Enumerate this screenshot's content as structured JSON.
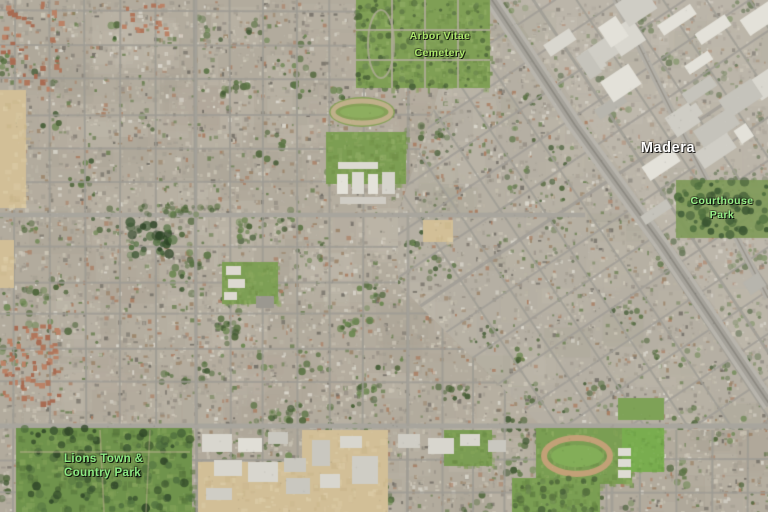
{
  "map": {
    "labels": [
      {
        "id": "arbor-vitae-cemetery",
        "text": "Arbor Vitae\nCemetery",
        "color": "#aee86d"
      },
      {
        "id": "madera",
        "text": "Madera",
        "color": "#ffffff"
      },
      {
        "id": "courthouse-park",
        "text": "Courthouse\nPark",
        "color": "#97f089"
      },
      {
        "id": "lions-town-country-park",
        "text": "Lions Town &\nCountry Park",
        "color": "#8deb84"
      }
    ],
    "colors": {
      "urban_base": "#b2ab9d",
      "park_green": "#6f934c",
      "cemetery_green": "#7f9f55",
      "bare_dirt": "#d2bf97",
      "road_gray": "#a8a59d",
      "rail_corridor": "#b8b5ad"
    }
  }
}
